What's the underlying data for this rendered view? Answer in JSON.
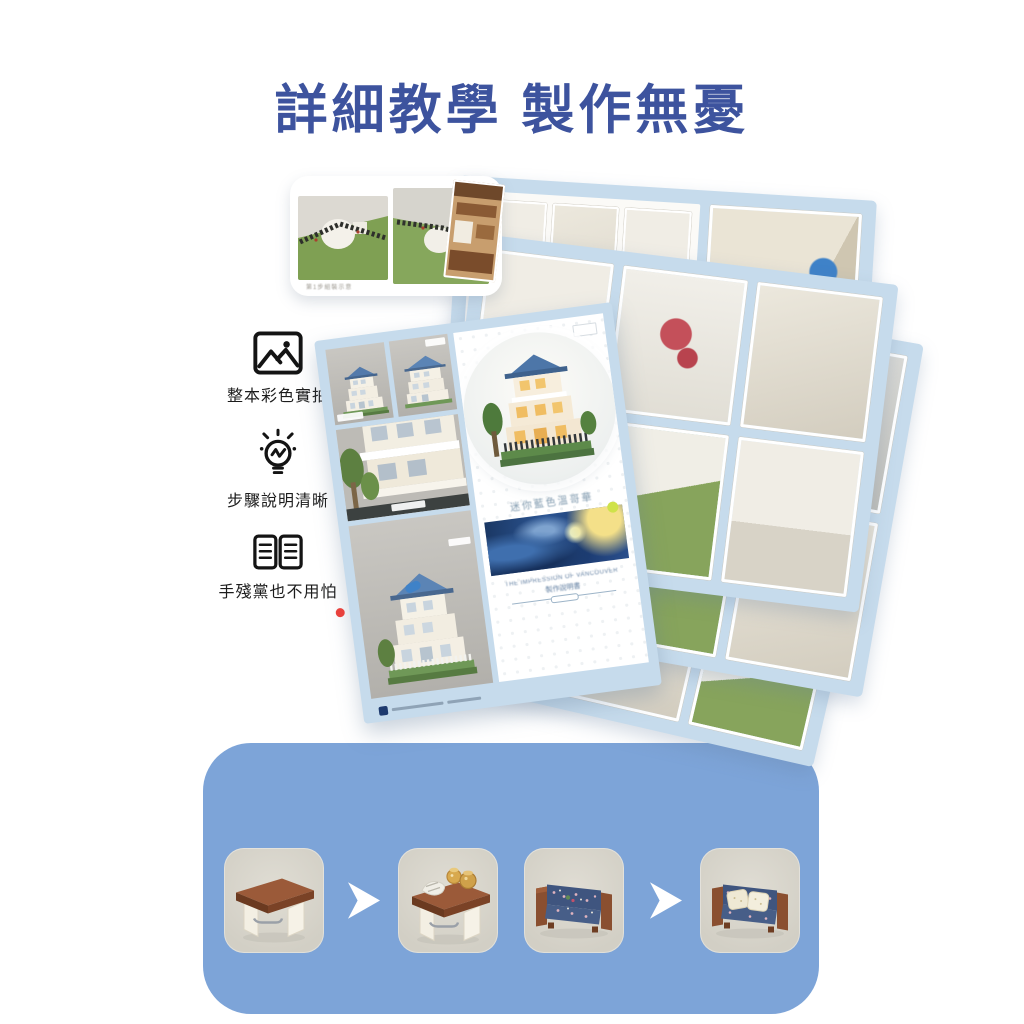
{
  "page": {
    "title": "詳細教學 製作無憂"
  },
  "colors": {
    "title_blue": "#3D539E",
    "panel_blue": "#7DA4D8",
    "manual_page_blue": "#C6DBEC",
    "tile_background": "#D9D6CC"
  },
  "features": [
    {
      "icon": "photo-icon",
      "label": "整本彩色實拍"
    },
    {
      "icon": "lightbulb-icon",
      "label": "步驟說明清晰"
    },
    {
      "icon": "open-book-icon",
      "label": "手殘黨也不用怕"
    }
  ],
  "manual": {
    "photo_card": {
      "caption": "第1步組裝示意"
    },
    "cover": {
      "subtitle": "迷你藍色溫哥華",
      "footer_en": "THE IMPRESSION OF VANCOUVER",
      "footer_cn": "製作說明書"
    }
  },
  "assembly_steps": {
    "steps": [
      {
        "id": "table-frame"
      },
      {
        "id": "table-with-decor"
      },
      {
        "id": "sofa-body"
      },
      {
        "id": "sofa-with-pillows"
      }
    ],
    "arrow_icon": "chevron-right-arrow"
  }
}
